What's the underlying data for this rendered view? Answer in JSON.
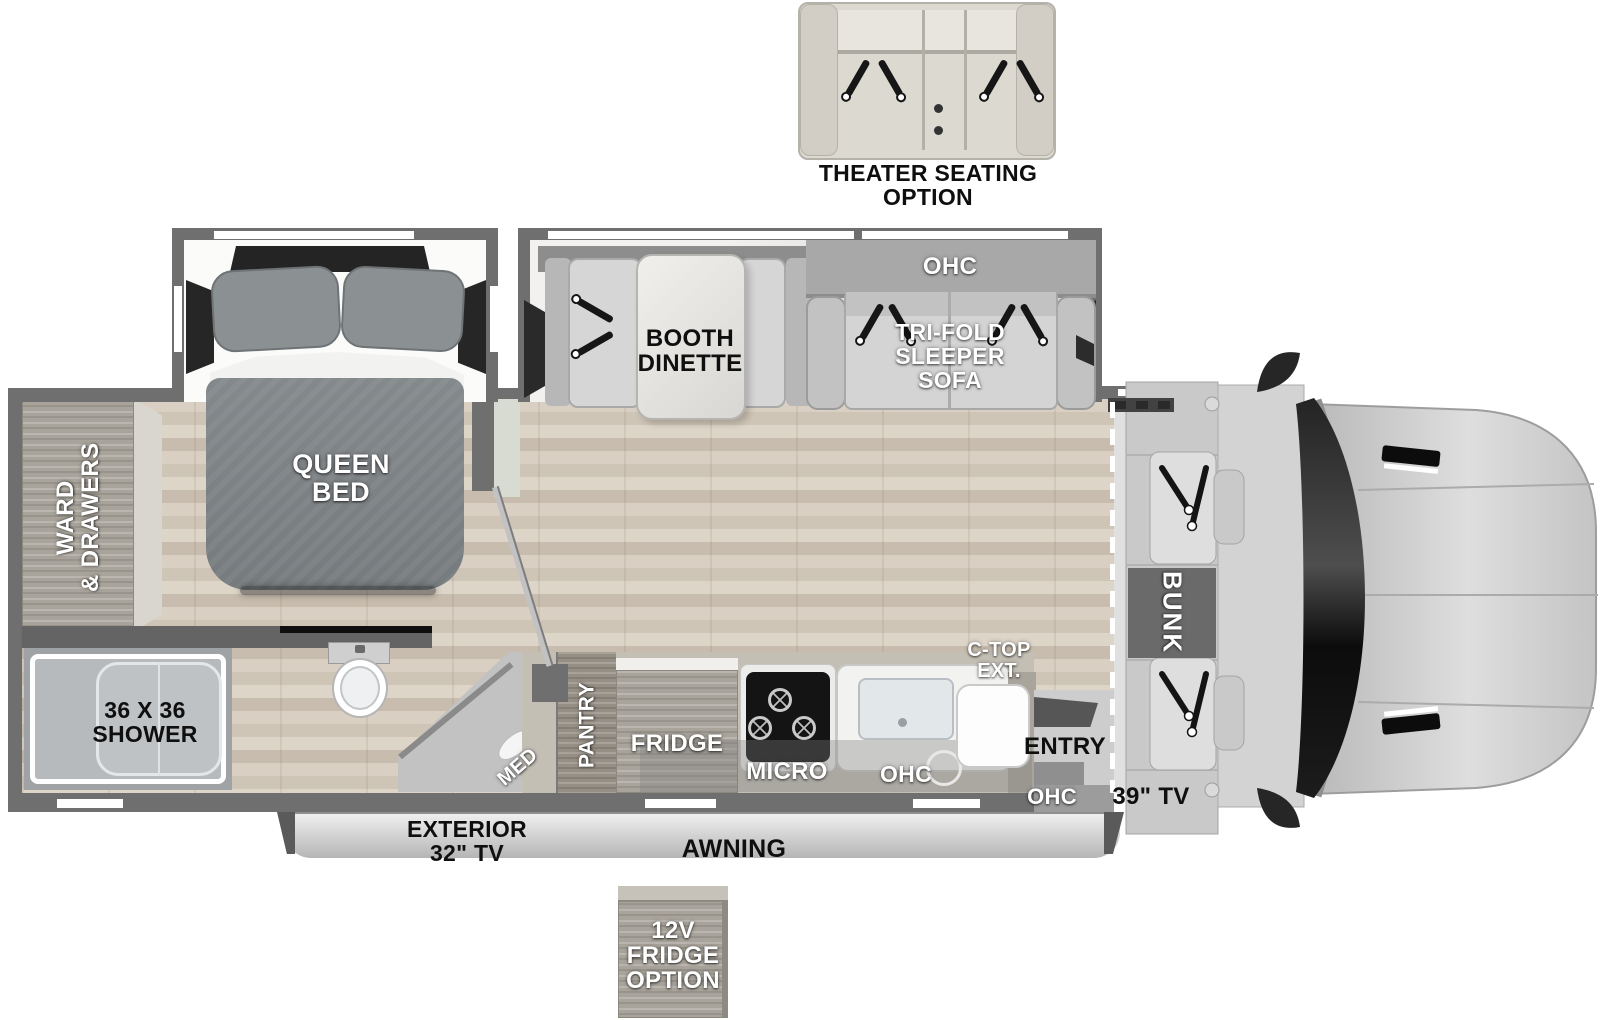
{
  "colors": {
    "wall": "#6f6f6f",
    "floor_wood": "#d3c9bc",
    "slide_floor": "#f4f3f1",
    "furniture_gray": "#d2d2d2",
    "cabinet_wood": "#a9a49b",
    "cab_body": "#cfcfcf",
    "windshield": "#1a1a1a",
    "label_white": "#ffffff",
    "label_black": "#0f0f0f"
  },
  "icons": {
    "seatbelt": "seatbelt-strap-icon"
  },
  "options": {
    "theater_seating": "THEATER SEATING\nOPTION",
    "fridge_12v": "12V\nFRIDGE\nOPTION"
  },
  "living": {
    "ohc": "OHC",
    "booth_dinette": "BOOTH\nDINETTE",
    "trifold_sofa": "TRI-FOLD\nSLEEPER\nSOFA"
  },
  "bedroom": {
    "queen_bed": "QUEEN\nBED",
    "ward_drawers": "WARD\n& DRAWERS"
  },
  "bath": {
    "shower": "36 X 36\nSHOWER",
    "med": "MED"
  },
  "kitchen": {
    "pantry": "PANTRY",
    "fridge": "FRIDGE",
    "micro": "MICRO",
    "ohc": "OHC",
    "ctop_ext": "C-TOP\nEXT.",
    "entry": "ENTRY",
    "ohc_entry": "OHC"
  },
  "front": {
    "bunk": "BUNK",
    "tv_39": "39\" TV"
  },
  "exterior": {
    "tv_32": "EXTERIOR\n32\" TV",
    "awning": "AWNING"
  }
}
